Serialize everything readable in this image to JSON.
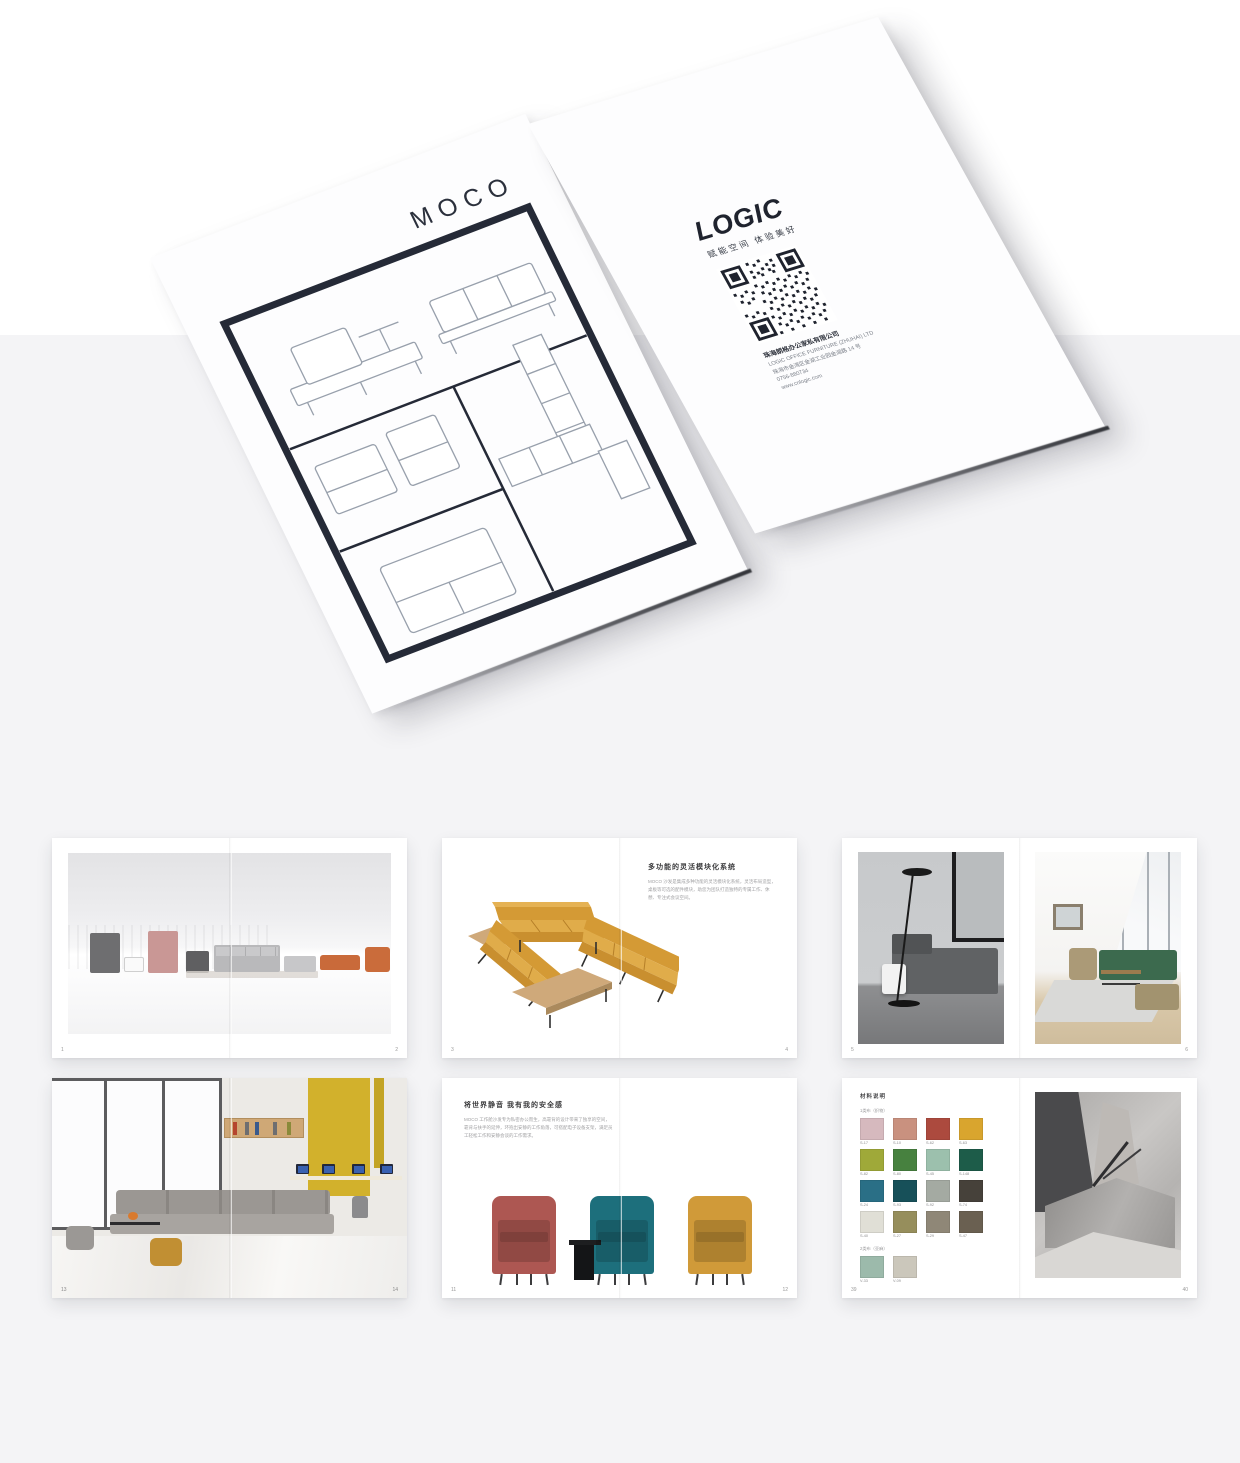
{
  "colors": {
    "background_top": "#ffffff",
    "background_bottom": "#f4f4f6",
    "brand_navy": "#252a37",
    "mustard_accent": "#d9a23f"
  },
  "cover": {
    "title": "MOCO"
  },
  "back_cover": {
    "brand": "LOGIC",
    "tagline": "赋能空间 体验美好",
    "company_cn": "珠海朗格办公家私有限公司",
    "company_en": "LOGIC OFFICE FURNITURE (ZHUHAI) LTD",
    "address": "珠海市金湾区金湖工业园金湖路 14 号",
    "phone": "0756-880734",
    "website": "www.cnlogic.com"
  },
  "spreads": {
    "s1": {
      "page_left": "1",
      "page_right": "2"
    },
    "s2": {
      "heading": "多功能的灵活模块化系统",
      "body": "MOCO 沙发是集成多种功能的灵活模块化系统，灵活布局造型，桌板等可选的配件模块，助您为团队打造独特的专属工作、休憩、专注式会议空间。",
      "page_left": "3",
      "page_right": "4"
    },
    "s3": {
      "page_left": "5",
      "page_right": "6"
    },
    "s4": {
      "page_left": "13",
      "page_right": "14"
    },
    "s5": {
      "heading": "将世界静音 我有我的安全感",
      "body": "MOCO 工作舱沙发专为私密办公而生，高靠背的设计带来了独享的空间，靠背与扶手的延伸，环抱出安静的工作角落，可搭配电子设备支架，满足员工轻松工作和安静会谈的工作需求。",
      "page_left": "11",
      "page_right": "12"
    },
    "s6": {
      "title": "材料说明",
      "group1_label": "1类布（织物）",
      "group2_label": "2类布（亚麻）",
      "group1": [
        {
          "code": "S-17",
          "color": "#d6b9be"
        },
        {
          "code": "S-10",
          "color": "#c9917f"
        },
        {
          "code": "S-62",
          "color": "#ac4a3e"
        },
        {
          "code": "S-63",
          "color": "#d9a52e"
        },
        {
          "code": "S-82",
          "color": "#9fa939"
        },
        {
          "code": "S-80",
          "color": "#47813f"
        },
        {
          "code": "S-45",
          "color": "#9cc0ad"
        },
        {
          "code": "S-148",
          "color": "#1d5c49"
        },
        {
          "code": "S-24",
          "color": "#2a6f86"
        },
        {
          "code": "S-93",
          "color": "#175059"
        },
        {
          "code": "S-92",
          "color": "#a4aaa2"
        },
        {
          "code": "S-74",
          "color": "#46413a"
        },
        {
          "code": "S-40",
          "color": "#e0dfd6"
        },
        {
          "code": "S-27",
          "color": "#968e5c"
        },
        {
          "code": "S-29",
          "color": "#8f8777"
        },
        {
          "code": "S-47",
          "color": "#6a6051"
        }
      ],
      "group2": [
        {
          "code": "V-33",
          "color": "#9cbaab"
        },
        {
          "code": "V-09",
          "color": "#cbc7bb"
        }
      ],
      "page_left": "39",
      "page_right": "40"
    }
  }
}
